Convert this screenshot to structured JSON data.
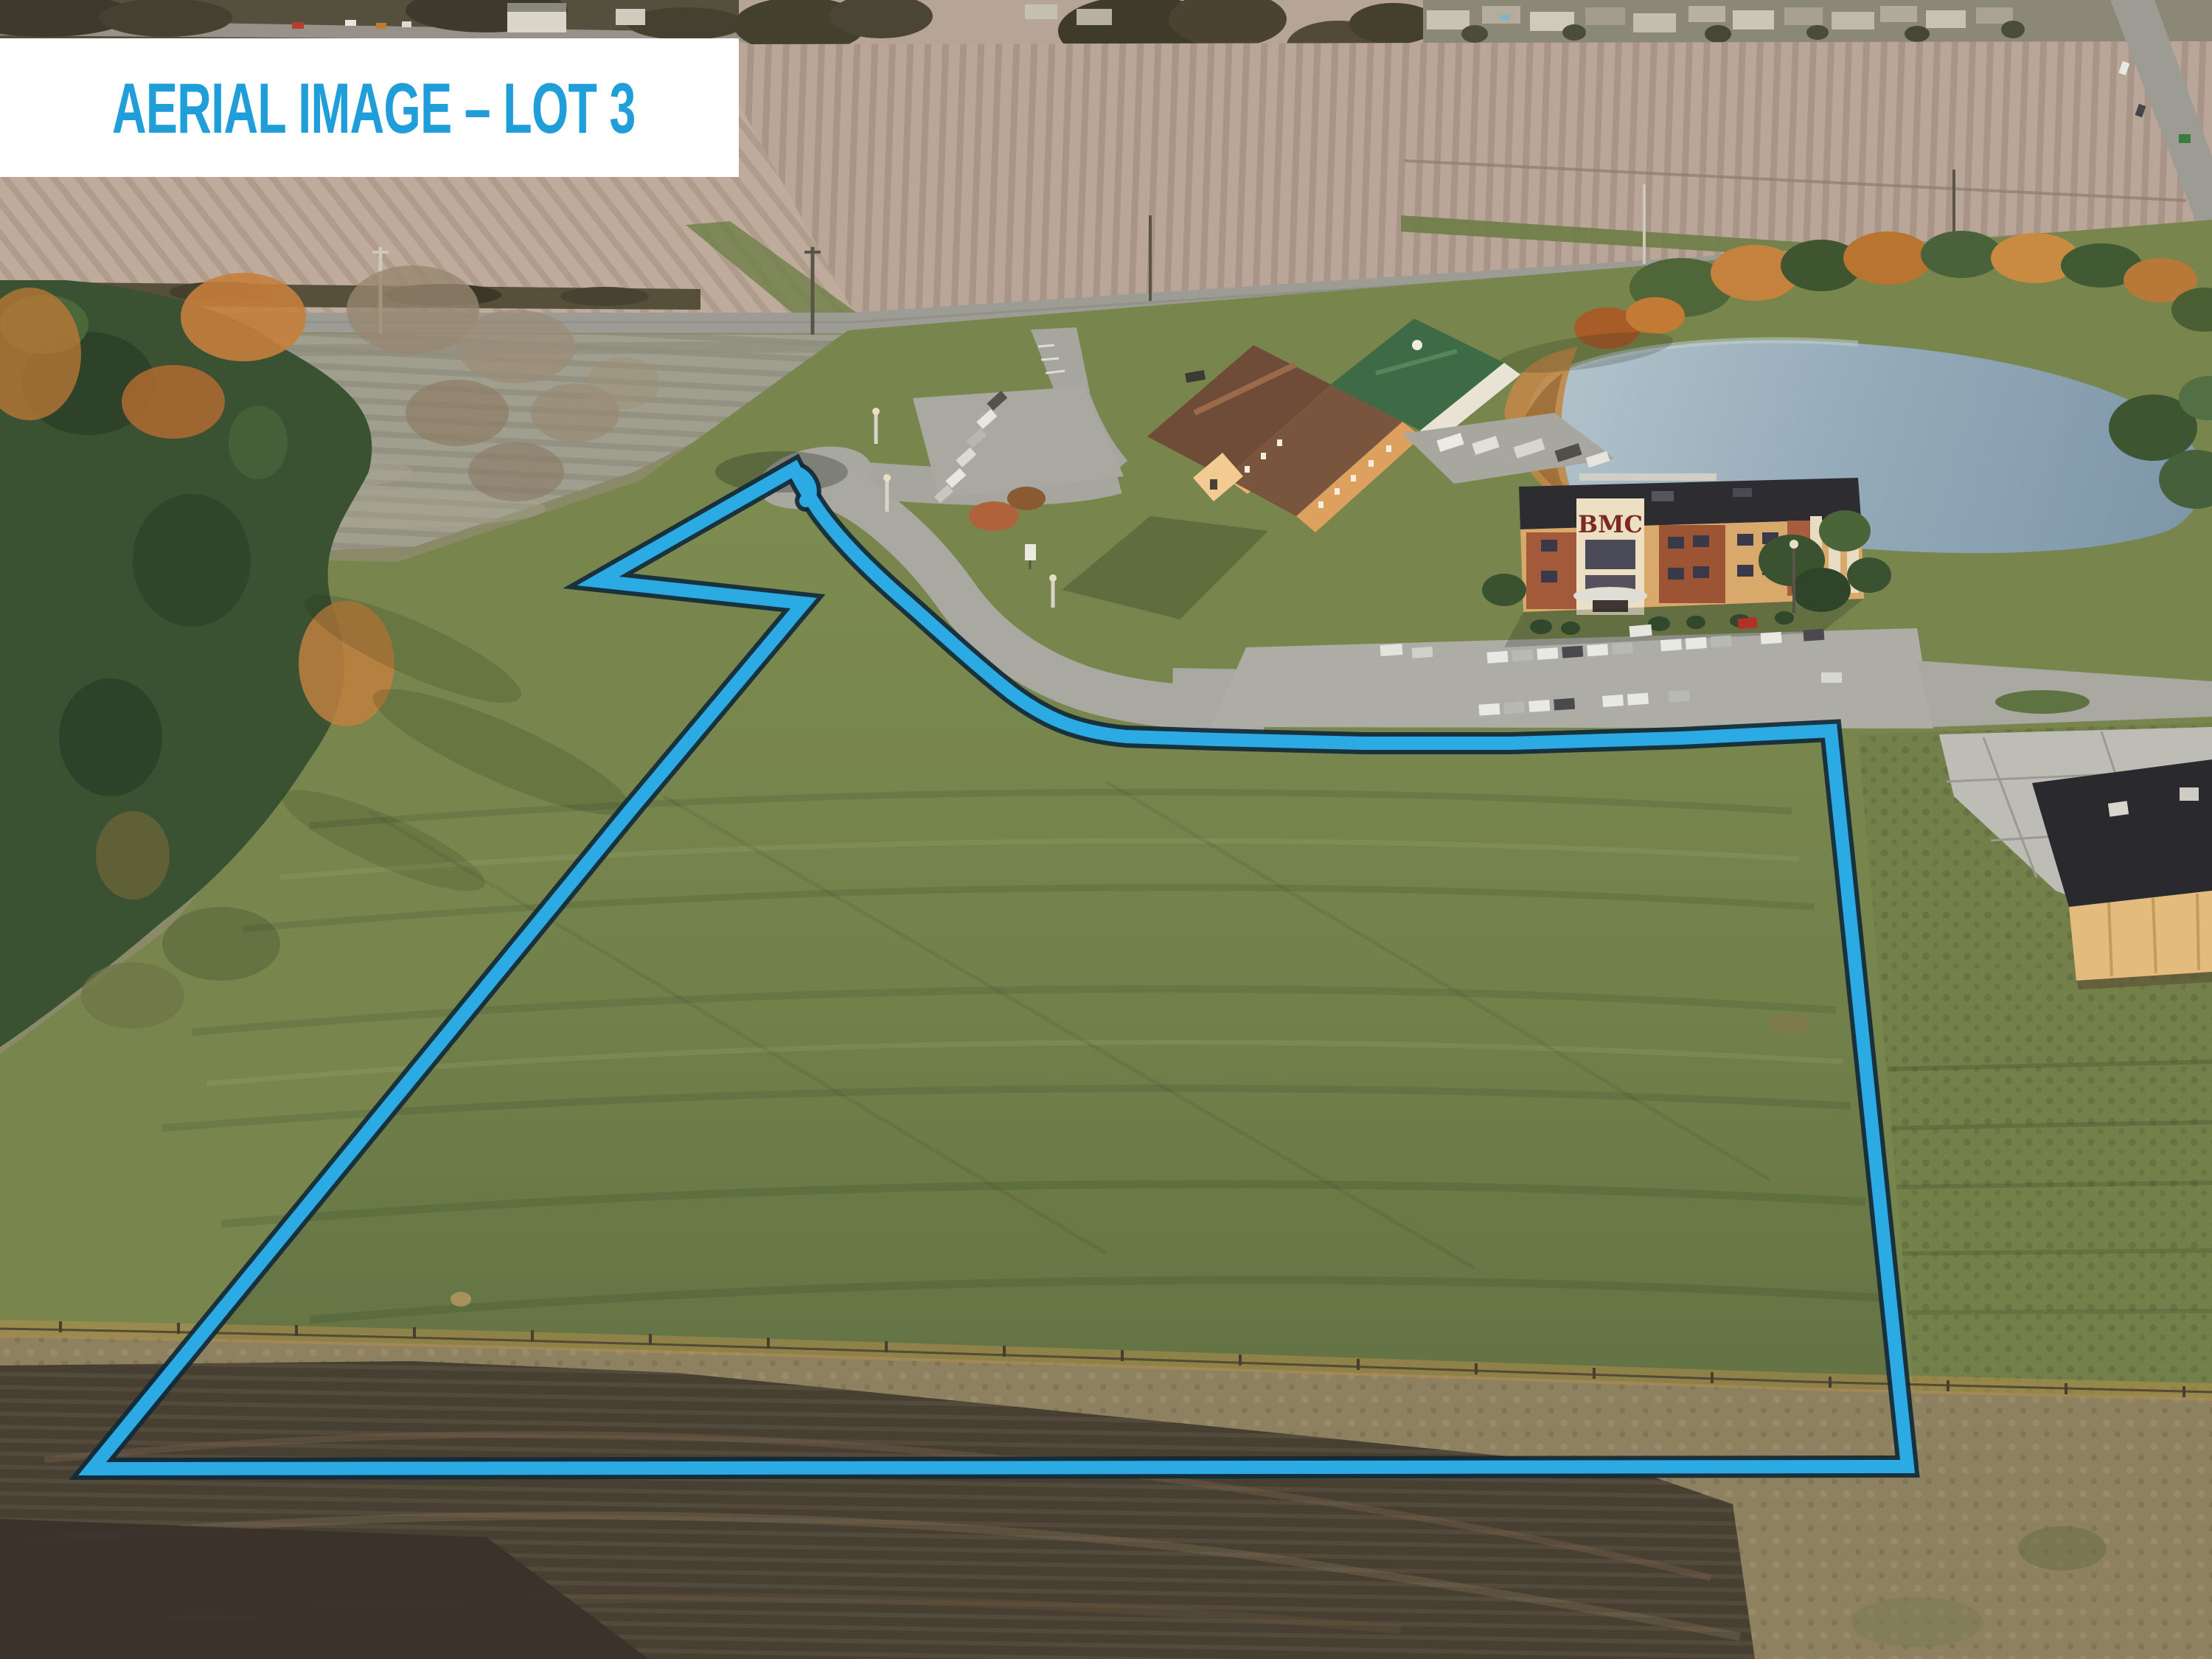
{
  "banner": {
    "title": "AERIAL IMAGE – LOT 3",
    "text_color": "#1f9ed9",
    "background_color": "#ffffff"
  },
  "photo": {
    "caption": "Aerial drone photo of vacant grass Lot 3 outlined in blue, beside a BMC office building, hotel complex, pond, highway and plowed farm fields",
    "lot_outline_color": "#2caae3",
    "lot_outline_edge_color": "#102a3a",
    "bmc_sign_text": "BMC"
  }
}
